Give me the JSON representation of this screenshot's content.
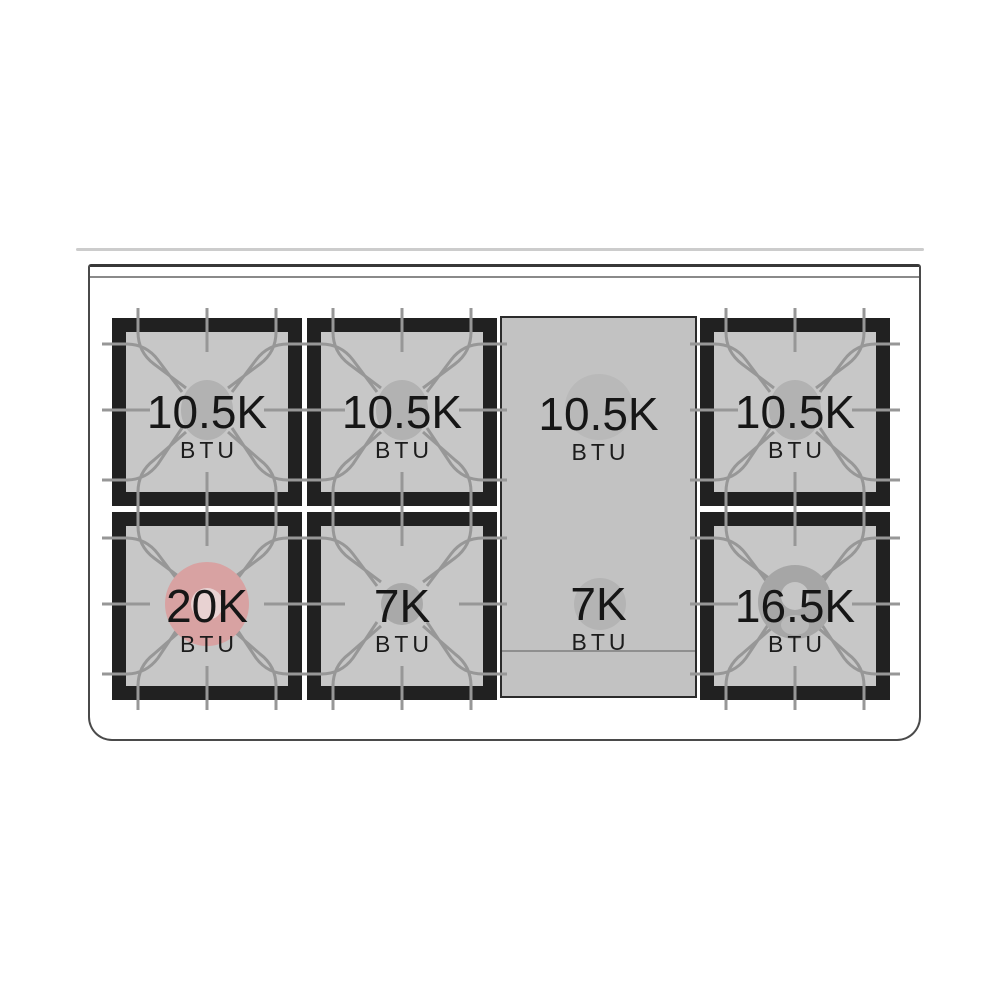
{
  "diagram": {
    "name": "range-cooktop-burner-layout",
    "rows": [
      "back",
      "front"
    ],
    "griddle_present": true
  },
  "burners": [
    {
      "location": "back-left",
      "power": "10.5K",
      "unit": "BTU",
      "cap_style": "gray-oval"
    },
    {
      "location": "back-center-left",
      "power": "10.5K",
      "unit": "BTU",
      "cap_style": "gray-oval"
    },
    {
      "location": "griddle-back",
      "power": "10.5K",
      "unit": "BTU",
      "cap_style": "faint-circle-under-griddle"
    },
    {
      "location": "back-right",
      "power": "10.5K",
      "unit": "BTU",
      "cap_style": "gray-oval"
    },
    {
      "location": "front-left",
      "power": "20K",
      "unit": "BTU",
      "cap_style": "red-ring-highlight"
    },
    {
      "location": "front-center-left",
      "power": "7K",
      "unit": "BTU",
      "cap_style": "small-gray-circle"
    },
    {
      "location": "griddle-front",
      "power": "7K",
      "unit": "BTU",
      "cap_style": "faint-circle-under-griddle"
    },
    {
      "location": "front-right",
      "power": "16.5K",
      "unit": "BTU",
      "cap_style": "gray-ring"
    }
  ],
  "colors": {
    "grate_frame": "#212121",
    "grate_surface": "#c7c7c7",
    "griddle_surface": "#c2c2c2",
    "grate_linework": "#979797",
    "burner_cap_gray": "#b2b2b2",
    "highlight_burner_red": "#d8a2a2",
    "text": "#161616",
    "body_outline": "#4a4a4a"
  }
}
